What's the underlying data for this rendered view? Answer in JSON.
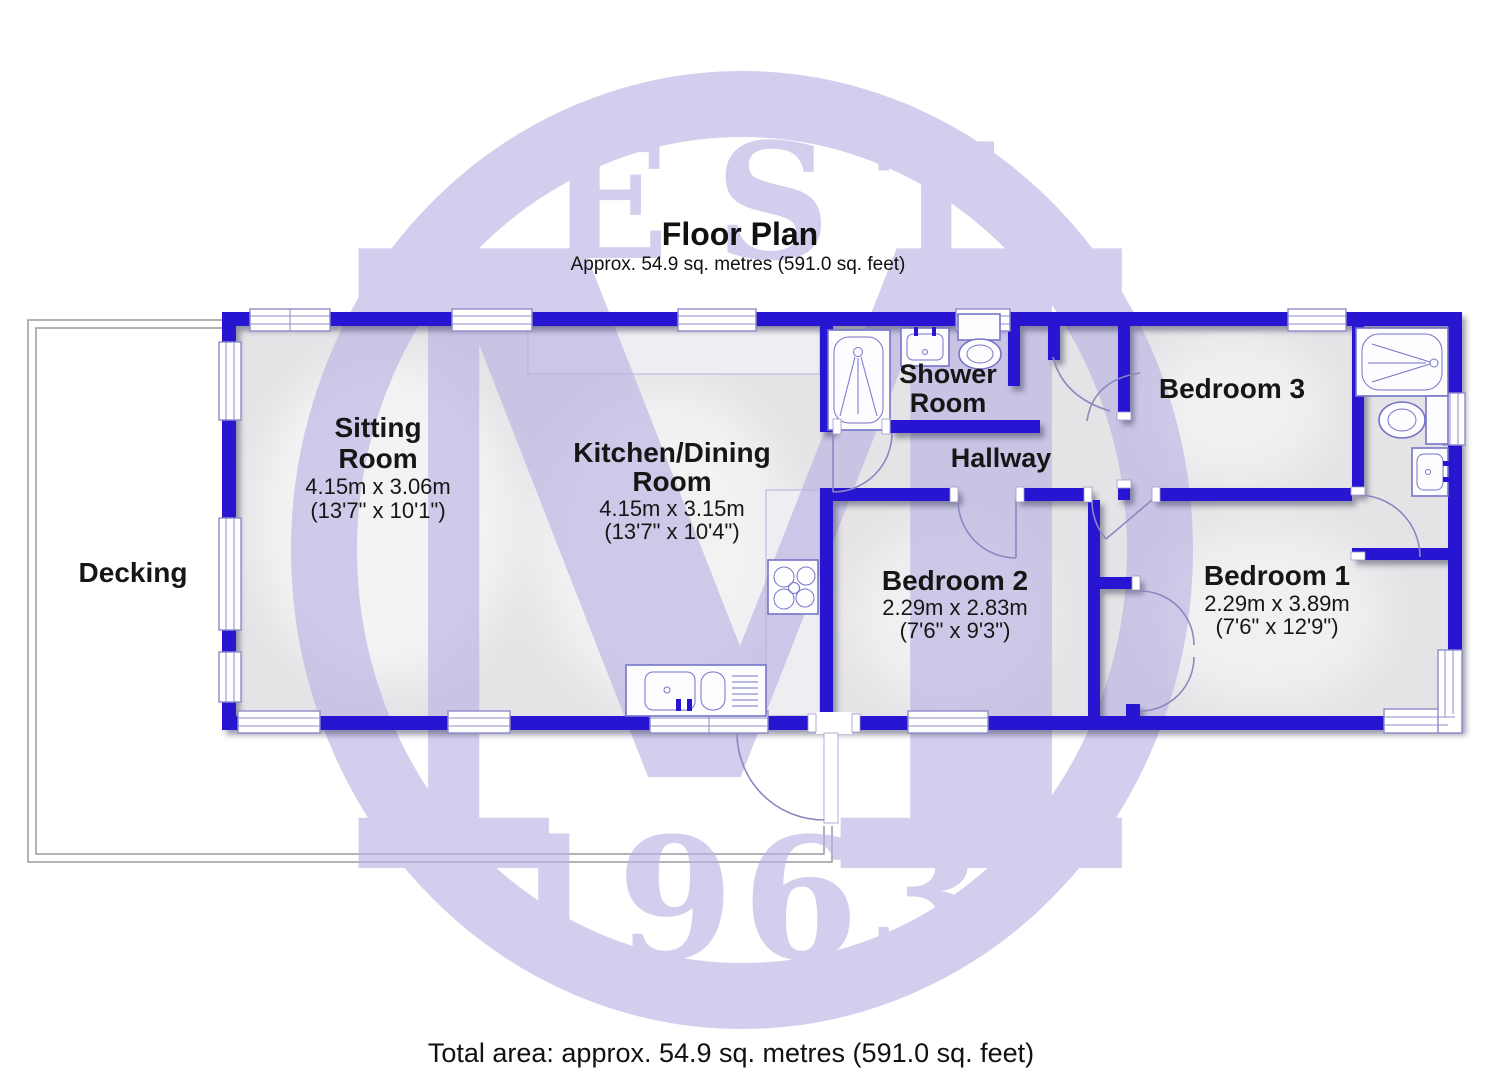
{
  "header": {
    "title": "Floor Plan",
    "subtitle": "Approx. 54.9 sq. metres (591.0 sq. feet)"
  },
  "footer": {
    "total_area": "Total area: approx. 54.9 sq. metres (591.0 sq. feet)"
  },
  "watermark": {
    "est": "EST.",
    "monogram": "M",
    "year": "1963"
  },
  "rooms": {
    "sitting_room": {
      "name": "Sitting Room",
      "line1": "Sitting",
      "line2": "Room",
      "metric": "4.15m x 3.06m",
      "imperial": "(13'7\" x 10'1\")"
    },
    "kitchen_dining": {
      "name": "Kitchen/Dining Room",
      "line1": "Kitchen/Dining",
      "line2": "Room",
      "metric": "4.15m x 3.15m",
      "imperial": "(13'7\" x 10'4\")"
    },
    "shower_room": {
      "name": "Shower Room",
      "line1": "Shower",
      "line2": "Room"
    },
    "hallway": {
      "name": "Hallway",
      "line1": "Hallway"
    },
    "bedroom_3": {
      "name": "Bedroom 3",
      "line1": "Bedroom 3"
    },
    "bedroom_2": {
      "name": "Bedroom 2",
      "line1": "Bedroom 2",
      "metric": "2.29m x 2.83m",
      "imperial": "(7'6\" x 9'3\")"
    },
    "bedroom_1": {
      "name": "Bedroom 1",
      "line1": "Bedroom 1",
      "metric": "2.29m x 3.89m",
      "imperial": "(7'6\" x 12'9\")"
    },
    "decking": {
      "name": "Decking",
      "line1": "Decking"
    }
  },
  "colors": {
    "wall_blue": "#2715d2",
    "watermark_lavender": "#b9b1e2",
    "room_fill": "#e4e4e7",
    "fixture_outline": "#7574c8"
  }
}
